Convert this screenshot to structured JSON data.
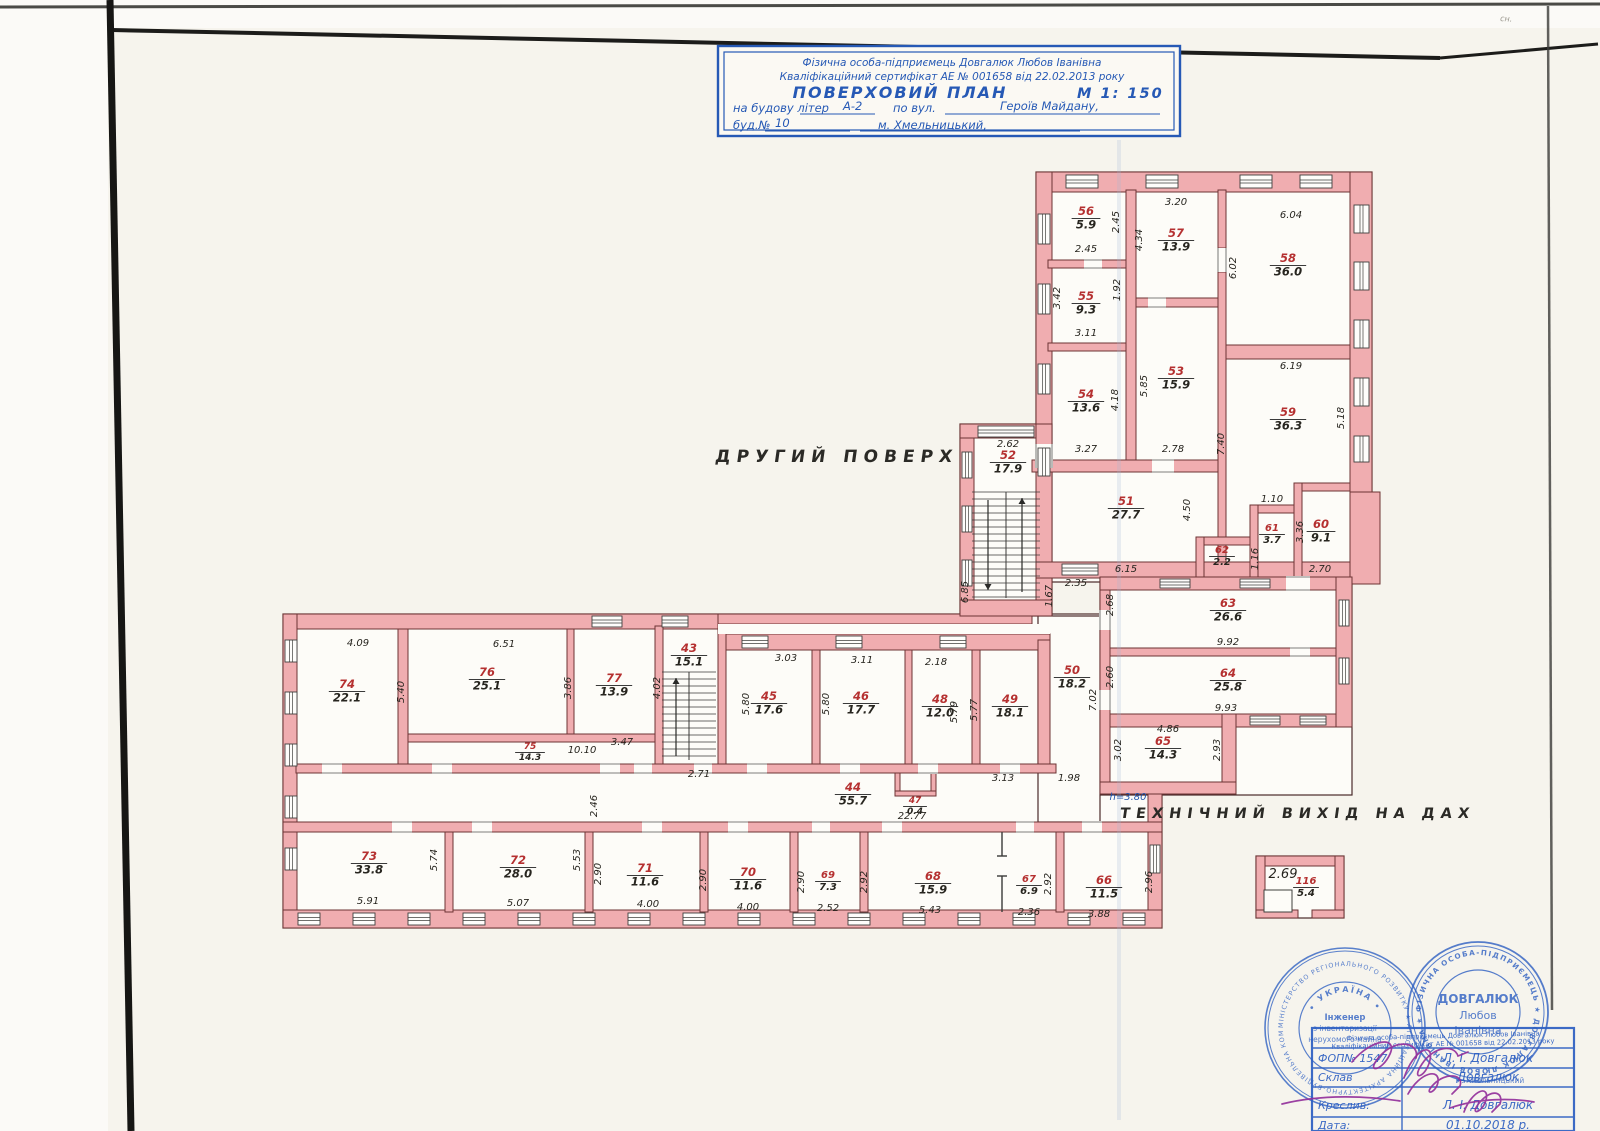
{
  "page": {
    "floor_label": "ДРУГИЙ ПОВЕРХ",
    "roof_exit_label": "ТЕХНІЧНИЙ ВИХІД НА ДАХ",
    "height_note": "h=3.80",
    "corner_mark": "сн."
  },
  "title_block": {
    "line1": "Фізична особа-підприємець Довгалюк Любов Іванівна",
    "line2": "Кваліфікаційний сертифікат АЕ №  001658  від  22.02.2013  року",
    "line3": "ПОВЕРХОВИЙ  ПЛАН",
    "scale": "М 1: 150",
    "line4_pre": "на  будову  літер",
    "line4_val": "А-2",
    "line4_mid": "по  вул.",
    "line4_street": "Героїв  Майдану,",
    "line5_pre": "буд.№",
    "line5_num": "10",
    "line5_city": "м.  Хмельницький,"
  },
  "rooms": [
    {
      "n": "74",
      "a": "22.1",
      "x": 347,
      "y": 688
    },
    {
      "n": "76",
      "a": "25.1",
      "x": 487,
      "y": 676
    },
    {
      "n": "77",
      "a": "13.9",
      "x": 614,
      "y": 682
    },
    {
      "n": "43",
      "a": "15.1",
      "x": 689,
      "y": 652
    },
    {
      "n": "45",
      "a": "17.6",
      "x": 769,
      "y": 700
    },
    {
      "n": "46",
      "a": "17.7",
      "x": 861,
      "y": 700
    },
    {
      "n": "48",
      "a": "12.0",
      "x": 940,
      "y": 703
    },
    {
      "n": "49",
      "a": "18.1",
      "x": 1010,
      "y": 703
    },
    {
      "n": "75",
      "a": "14.3",
      "x": 530,
      "y": 749,
      "s": 9
    },
    {
      "n": "44",
      "a": "55.7",
      "x": 853,
      "y": 791
    },
    {
      "n": "47",
      "a": "0.4",
      "x": 915,
      "y": 803,
      "s": 9
    },
    {
      "n": "50",
      "a": "18.2",
      "x": 1072,
      "y": 674
    },
    {
      "n": "51",
      "a": "27.7",
      "x": 1126,
      "y": 505
    },
    {
      "n": "52",
      "a": "17.9",
      "x": 1008,
      "y": 459
    },
    {
      "n": "53",
      "a": "15.9",
      "x": 1176,
      "y": 375
    },
    {
      "n": "54",
      "a": "13.6",
      "x": 1086,
      "y": 398
    },
    {
      "n": "55",
      "a": "9.3",
      "x": 1086,
      "y": 300
    },
    {
      "n": "56",
      "a": "5.9",
      "x": 1086,
      "y": 215
    },
    {
      "n": "57",
      "a": "13.9",
      "x": 1176,
      "y": 237
    },
    {
      "n": "58",
      "a": "36.0",
      "x": 1288,
      "y": 262
    },
    {
      "n": "59",
      "a": "36.3",
      "x": 1288,
      "y": 416
    },
    {
      "n": "60",
      "a": "9.1",
      "x": 1321,
      "y": 528
    },
    {
      "n": "61",
      "a": "3.7",
      "x": 1272,
      "y": 531,
      "s": 10
    },
    {
      "n": "62",
      "a": "2.2",
      "x": 1222,
      "y": 553,
      "s": 10
    },
    {
      "n": "63",
      "a": "26.6",
      "x": 1228,
      "y": 607
    },
    {
      "n": "64",
      "a": "25.8",
      "x": 1228,
      "y": 677
    },
    {
      "n": "65",
      "a": "14.3",
      "x": 1163,
      "y": 745
    },
    {
      "n": "66",
      "a": "11.5",
      "x": 1104,
      "y": 884
    },
    {
      "n": "67",
      "a": "6.9",
      "x": 1029,
      "y": 882,
      "s": 10
    },
    {
      "n": "68",
      "a": "15.9",
      "x": 933,
      "y": 880
    },
    {
      "n": "69",
      "a": "7.3",
      "x": 828,
      "y": 878,
      "s": 10
    },
    {
      "n": "70",
      "a": "11.6",
      "x": 748,
      "y": 876
    },
    {
      "n": "71",
      "a": "11.6",
      "x": 645,
      "y": 872
    },
    {
      "n": "72",
      "a": "28.0",
      "x": 518,
      "y": 864
    },
    {
      "n": "73",
      "a": "33.8",
      "x": 369,
      "y": 860
    },
    {
      "n": "116",
      "a": "5.4",
      "x": 1306,
      "y": 884,
      "s": 10
    }
  ],
  "dims": [
    [
      "4.09",
      358,
      646,
      0
    ],
    [
      "5.40",
      404,
      692,
      1
    ],
    [
      "6.51",
      504,
      647,
      0
    ],
    [
      "3.86",
      571,
      688,
      1
    ],
    [
      "3.47",
      622,
      745,
      0
    ],
    [
      "4.02",
      660,
      688,
      1
    ],
    [
      "2.71",
      699,
      777,
      0
    ],
    [
      "10.10",
      582,
      753,
      0
    ],
    [
      "3.03",
      786,
      661,
      0
    ],
    [
      "5.80",
      749,
      704,
      1
    ],
    [
      "3.11",
      862,
      663,
      0
    ],
    [
      "5.80",
      829,
      704,
      1
    ],
    [
      "2.18",
      936,
      665,
      0
    ],
    [
      "5.79",
      957,
      712,
      1
    ],
    [
      "5.77",
      977,
      710,
      1
    ],
    [
      "3.13",
      1003,
      781,
      0
    ],
    [
      "1.98",
      1069,
      781,
      0
    ],
    [
      "22.77",
      912,
      819,
      0
    ],
    [
      "h=3.80",
      1128,
      800,
      0,
      1
    ],
    [
      "2.90",
      601,
      874,
      1
    ],
    [
      "4.00",
      648,
      907,
      0
    ],
    [
      "2.90",
      706,
      880,
      1
    ],
    [
      "4.00",
      748,
      910,
      0
    ],
    [
      "2.90",
      804,
      882,
      1
    ],
    [
      "2.52",
      828,
      911,
      0
    ],
    [
      "2.92",
      867,
      882,
      1
    ],
    [
      "5.43",
      930,
      913,
      0
    ],
    [
      "2.36",
      1029,
      915,
      0
    ],
    [
      "2.92",
      1051,
      884,
      1
    ],
    [
      "3.88",
      1099,
      917,
      0
    ],
    [
      "2.96",
      1152,
      882,
      1
    ],
    [
      "5.91",
      368,
      904,
      0
    ],
    [
      "5.74",
      437,
      860,
      1
    ],
    [
      "5.07",
      518,
      906,
      0
    ],
    [
      "5.53",
      580,
      860,
      1
    ],
    [
      "2.46",
      597,
      806,
      1
    ],
    [
      "2.45",
      1119,
      222,
      1
    ],
    [
      "2.45",
      1086,
      252,
      0
    ],
    [
      "3.20",
      1176,
      205,
      0
    ],
    [
      "4.34",
      1142,
      240,
      1
    ],
    [
      "6.04",
      1291,
      218,
      0
    ],
    [
      "6.02",
      1236,
      268,
      1
    ],
    [
      "3.42",
      1060,
      298,
      1
    ],
    [
      "1.92",
      1120,
      290,
      1
    ],
    [
      "3.11",
      1086,
      336,
      0
    ],
    [
      "5.85",
      1147,
      386,
      1
    ],
    [
      "2.78",
      1173,
      452,
      0
    ],
    [
      "3.27",
      1086,
      452,
      0
    ],
    [
      "4.18",
      1118,
      400,
      1
    ],
    [
      "6.19",
      1291,
      369,
      0
    ],
    [
      "5.18",
      1344,
      418,
      1
    ],
    [
      "7.40",
      1224,
      444,
      1
    ],
    [
      "2.62",
      1008,
      447,
      0
    ],
    [
      "6.85",
      968,
      592,
      1
    ],
    [
      "1.10",
      1272,
      502,
      0
    ],
    [
      "3.36",
      1303,
      532,
      1
    ],
    [
      "2.70",
      1320,
      572,
      0
    ],
    [
      "1.16",
      1258,
      559,
      1
    ],
    [
      "6.15",
      1126,
      572,
      0
    ],
    [
      "4.50",
      1190,
      510,
      1
    ],
    [
      "2.35",
      1076,
      586,
      0
    ],
    [
      "1.67",
      1052,
      596,
      1
    ],
    [
      "2.68",
      1113,
      605,
      1
    ],
    [
      "9.92",
      1228,
      645,
      0
    ],
    [
      "2.60",
      1113,
      677,
      1
    ],
    [
      "9.93",
      1226,
      711,
      0
    ],
    [
      "7.02",
      1096,
      700,
      1
    ],
    [
      "4.86",
      1168,
      732,
      0
    ],
    [
      "3.02",
      1121,
      750,
      1
    ],
    [
      "2.93",
      1220,
      750,
      1
    ],
    [
      "2.69",
      1283,
      878,
      0,
      0,
      13
    ]
  ],
  "stamps": {
    "ring1_text": "МІНІСТЕРСТВО РЕГІОНАЛЬНОГО РОЗВИТКУ ★ АТЕСТАЦІЙНА АРХІТЕКТУРНО-БУДІВЕЛЬНА КОМІСІЯ ★",
    "ring1_arc": "• УКРАЇНА •",
    "ring1_center": [
      "Інженер",
      "з інвентаризації",
      "нерухомого майна"
    ],
    "ring2_text": "ФІЗИЧНА ОСОБА-ПІДПРИЄМЕЦЬ  ★  ДОВГАЛЮК ЛЮБОВ ІВАНІВНА  ★",
    "ring2_center": [
      "ДОВГАЛЮК",
      "Любов",
      "Іванівна"
    ],
    "table": {
      "header1": "Фізична особа-підприємець Довгалюк Любов Іванівна",
      "header2": "Кваліфікаційний сертифікат АЕ № 001658 від 22.02.2013 року",
      "overprint": "м. Хмельницький",
      "rows": [
        {
          "label": "ФОП№ 1547",
          "value": "Л. І. Довгалюк"
        },
        {
          "label": "Склав",
          "value": "Довгалюк"
        },
        {
          "label": "Креслив:",
          "value": "Л. І. Довгалюк"
        },
        {
          "label": "Дата:",
          "value": "01.10.2018 р."
        }
      ]
    }
  },
  "colors": {
    "wall_fill": "#f0adb0",
    "wall_stroke": "#6d3434",
    "room_number": "#b53030",
    "ink": "#27251f",
    "blue": "#2659b5",
    "stamp_blue": "#2d5fc2",
    "purple": "#93309b",
    "paper": "#f6f4ed"
  }
}
